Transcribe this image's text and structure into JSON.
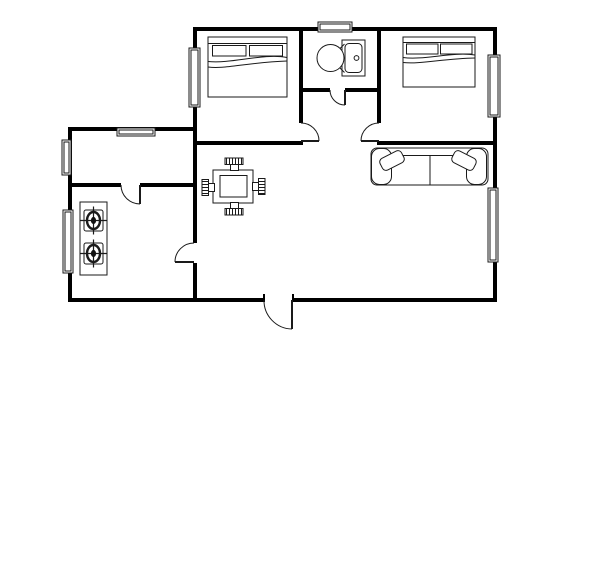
{
  "canvas": {
    "w": 600,
    "h": 584,
    "bg": "#ffffff",
    "wall_color": "#000000",
    "line_color": "#1a1a1a"
  },
  "floorplan": {
    "walls": [
      {
        "name": "wall-top",
        "x": 193,
        "y": 27,
        "w": 304,
        "h": 4
      },
      {
        "name": "wall-right",
        "x": 493,
        "y": 27,
        "w": 4,
        "h": 275
      },
      {
        "name": "wall-bottom-left",
        "x": 68,
        "y": 298,
        "w": 197,
        "h": 4
      },
      {
        "name": "wall-bottom-right",
        "x": 292,
        "y": 298,
        "w": 205,
        "h": 4
      },
      {
        "name": "wall-left",
        "x": 68,
        "y": 127,
        "w": 4,
        "h": 175
      },
      {
        "name": "wall-kitchen-top",
        "x": 68,
        "y": 127,
        "w": 129,
        "h": 4
      },
      {
        "name": "wall-x193-upper",
        "x": 193,
        "y": 27,
        "w": 4,
        "h": 216
      },
      {
        "name": "wall-x193-lower",
        "x": 193,
        "y": 263,
        "w": 4,
        "h": 39
      },
      {
        "name": "wall-bathroom-west",
        "x": 299,
        "y": 27,
        "w": 4,
        "h": 96
      },
      {
        "name": "wall-bedroom-left-south",
        "x": 193,
        "y": 141,
        "w": 110,
        "h": 4
      },
      {
        "name": "wall-bathroom-south-a",
        "x": 299,
        "y": 88,
        "w": 31,
        "h": 4
      },
      {
        "name": "wall-bathroom-south-b",
        "x": 345,
        "y": 88,
        "w": 36,
        "h": 4
      },
      {
        "name": "wall-bedroom-right-west",
        "x": 377,
        "y": 27,
        "w": 4,
        "h": 96
      },
      {
        "name": "wall-bedroom-right-south",
        "x": 377,
        "y": 141,
        "w": 120,
        "h": 4
      },
      {
        "name": "wall-kitchen-hall-a",
        "x": 68,
        "y": 183,
        "w": 53,
        "h": 4
      },
      {
        "name": "wall-kitchen-hall-b",
        "x": 140,
        "y": 183,
        "w": 56,
        "h": 4
      },
      {
        "name": "entrance-jamb-left",
        "x": 263,
        "y": 294,
        "w": 2,
        "h": 5
      },
      {
        "name": "entrance-jamb-right",
        "x": 292,
        "y": 294,
        "w": 2,
        "h": 5
      }
    ],
    "windows": [
      {
        "name": "window-bedroom-left-west",
        "x": 189,
        "y": 48,
        "w": 11,
        "h": 59
      },
      {
        "name": "window-bathroom-north",
        "x": 318,
        "y": 22,
        "w": 34,
        "h": 10
      },
      {
        "name": "window-bedroom-right-east",
        "x": 488,
        "y": 55,
        "w": 12,
        "h": 62
      },
      {
        "name": "window-living-east",
        "x": 488,
        "y": 188,
        "w": 10,
        "h": 74
      },
      {
        "name": "window-kitchen-north",
        "x": 117,
        "y": 128,
        "w": 38,
        "h": 8
      },
      {
        "name": "window-kitchen-west-upper",
        "x": 62,
        "y": 140,
        "w": 9,
        "h": 35
      },
      {
        "name": "window-kitchen-west-lower",
        "x": 63,
        "y": 210,
        "w": 10,
        "h": 63
      }
    ],
    "doors": [
      {
        "name": "bedroom-left-door",
        "jamb": [
          301,
          123
        ],
        "open": [
          319,
          141
        ],
        "hinge": [
          301,
          141
        ],
        "r": 18,
        "sweep": 1
      },
      {
        "name": "bedroom-right-door",
        "jamb": [
          379,
          123
        ],
        "open": [
          361,
          141
        ],
        "hinge": [
          379,
          141
        ],
        "r": 18,
        "sweep": 0
      },
      {
        "name": "bathroom-door",
        "jamb": [
          330,
          90
        ],
        "open": [
          345,
          105
        ],
        "hinge": [
          345,
          90
        ],
        "r": 15,
        "sweep": 0
      },
      {
        "name": "kitchen-door",
        "jamb": [
          121,
          185
        ],
        "open": [
          140,
          204
        ],
        "hinge": [
          140,
          185
        ],
        "r": 19,
        "sweep": 0
      },
      {
        "name": "kitchen-living-door",
        "jamb": [
          194,
          243
        ],
        "open": [
          175,
          262
        ],
        "hinge": [
          194,
          262
        ],
        "r": 19,
        "sweep": 0
      },
      {
        "name": "entrance-door",
        "jamb": [
          264,
          300
        ],
        "open": [
          292,
          329
        ],
        "hinge": [
          292,
          300
        ],
        "r": 28.5,
        "sweep": 0
      }
    ],
    "furniture": [
      {
        "name": "bed-left",
        "items": [
          {
            "t": "rect",
            "x": 208,
            "y": 37,
            "w": 79,
            "h": 60
          },
          {
            "t": "line",
            "x1": 208,
            "y1": 43.5,
            "x2": 287,
            "y2": 43.5
          },
          {
            "t": "rect",
            "x": 212.5,
            "y": 45.5,
            "w": 33.5,
            "h": 10.5
          },
          {
            "t": "rect",
            "x": 249.5,
            "y": 45.5,
            "w": 33,
            "h": 10.5
          },
          {
            "t": "path",
            "d": "M208,61.5 C232,64 263,53 287,57.5"
          },
          {
            "t": "path",
            "d": "M208,67 C224,69.5 246,62.5 287,61"
          }
        ]
      },
      {
        "name": "bed-right",
        "items": [
          {
            "t": "rect",
            "x": 403,
            "y": 37,
            "w": 72,
            "h": 50
          },
          {
            "t": "line",
            "x1": 403,
            "y1": 42.5,
            "x2": 475,
            "y2": 42.5
          },
          {
            "t": "rect",
            "x": 406.5,
            "y": 44,
            "w": 31.5,
            "h": 10
          },
          {
            "t": "rect",
            "x": 440.5,
            "y": 44,
            "w": 31.5,
            "h": 10
          },
          {
            "t": "path",
            "d": "M403,57.5 C424,60.5 452,51.5 475,55"
          },
          {
            "t": "path",
            "d": "M403,62.5 C420,64.5 444,58.5 475,58"
          }
        ]
      },
      {
        "name": "toilet",
        "items": [
          {
            "t": "rect",
            "x": 342,
            "y": 40,
            "w": 23,
            "h": 36
          },
          {
            "t": "rect",
            "x": 345,
            "y": 43.5,
            "w": 17,
            "h": 29,
            "rx": 4
          },
          {
            "t": "ellipse",
            "cx": 356.5,
            "cy": 58,
            "rx": 2.4,
            "ry": 2.4
          },
          {
            "t": "ellipse",
            "cx": 330.5,
            "cy": 58,
            "rx": 13.5,
            "ry": 13.5,
            "f": "#ffffff"
          },
          {
            "t": "path",
            "d": "M340,48.5 L344.5,44"
          },
          {
            "t": "path",
            "d": "M340,68 L344.5,72.5"
          }
        ]
      },
      {
        "name": "sofa",
        "items": [
          {
            "t": "rect",
            "x": 371,
            "y": 148,
            "w": 117,
            "h": 37,
            "rx": 6
          },
          {
            "t": "rect",
            "x": 371.5,
            "y": 148.5,
            "w": 20,
            "h": 36,
            "rx": 8
          },
          {
            "t": "rect",
            "x": 466.5,
            "y": 148.5,
            "w": 20,
            "h": 36,
            "rx": 8
          },
          {
            "t": "line",
            "x1": 391.5,
            "y1": 155.5,
            "x2": 466.5,
            "y2": 155.5
          },
          {
            "t": "line",
            "x1": 430,
            "y1": 155.5,
            "x2": 430,
            "y2": 184.5
          },
          {
            "t": "rotrect",
            "cx": 392,
            "cy": 160.5,
            "w": 24,
            "h": 13,
            "rx": 4,
            "a": -27
          },
          {
            "t": "rotrect",
            "cx": 464,
            "cy": 160.5,
            "w": 24,
            "h": 13,
            "rx": 4,
            "a": 27
          }
        ]
      },
      {
        "name": "dining-table",
        "items": [
          {
            "t": "rect",
            "x": 213,
            "y": 170,
            "w": 40,
            "h": 33
          },
          {
            "t": "rect",
            "x": 220,
            "y": 175.5,
            "w": 27,
            "h": 21.5
          },
          {
            "t": "rect",
            "x": 230.5,
            "y": 164.5,
            "w": 8,
            "h": 6
          },
          {
            "t": "comb",
            "x": 225,
            "y": 158,
            "w": 18,
            "h": 6.5,
            "dir": "V"
          },
          {
            "t": "rect",
            "x": 230.5,
            "y": 202.5,
            "w": 8,
            "h": 6
          },
          {
            "t": "comb",
            "x": 225,
            "y": 208.5,
            "w": 18,
            "h": 6.5,
            "dir": "V"
          },
          {
            "t": "rect",
            "x": 208.5,
            "y": 183.5,
            "w": 6,
            "h": 8
          },
          {
            "t": "comb",
            "x": 202,
            "y": 179.5,
            "w": 6.5,
            "h": 16,
            "dir": "H"
          },
          {
            "t": "rect",
            "x": 252.5,
            "y": 182.5,
            "w": 6,
            "h": 8
          },
          {
            "t": "comb",
            "x": 258.5,
            "y": 178.5,
            "w": 6.5,
            "h": 16,
            "dir": "H"
          }
        ]
      },
      {
        "name": "stove",
        "items": [
          {
            "t": "rect",
            "x": 80,
            "y": 202,
            "w": 27,
            "h": 73
          },
          {
            "t": "burner",
            "cx": 93.5,
            "cy": 220.5
          },
          {
            "t": "burner",
            "cx": 93.5,
            "cy": 253.5
          }
        ]
      }
    ]
  }
}
